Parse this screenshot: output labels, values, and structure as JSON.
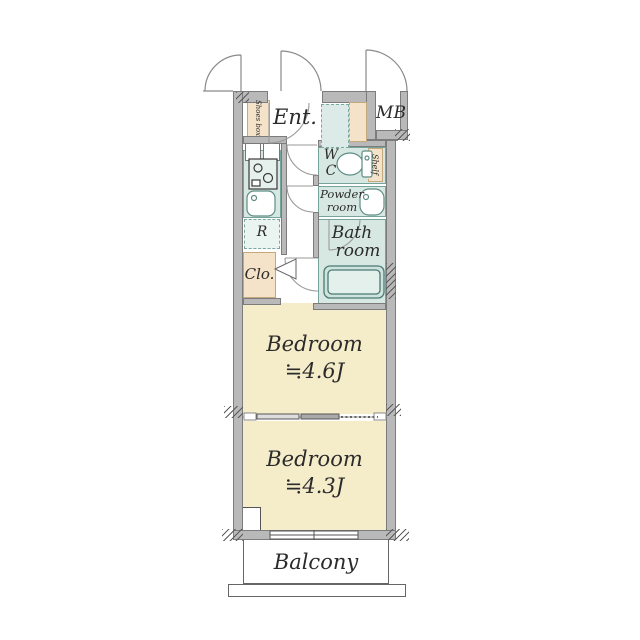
{
  "floor_plan": {
    "rooms": {
      "entrance": {
        "label": "Ent."
      },
      "meter_box": {
        "label": "MB"
      },
      "shoes_box": {
        "label": "Shoes box"
      },
      "washer_space": {
        "label": "W"
      },
      "entrance_shelf": {
        "label": "Shelf"
      },
      "wc": {
        "label_line1": "W",
        "label_line2": "C"
      },
      "wc_shelf": {
        "label": "Shelf"
      },
      "powder_room": {
        "label_line1": "Powder",
        "label_line2": "room"
      },
      "bath_room": {
        "label_line1": "Bath",
        "label_line2": "room"
      },
      "refrigerator_space": {
        "label": "R"
      },
      "closet": {
        "label": "Clo."
      },
      "bedroom_1": {
        "label": "Bedroom",
        "size": "≒4.6J"
      },
      "bedroom_2": {
        "label": "Bedroom",
        "size": "≒4.3J"
      },
      "balcony": {
        "label": "Balcony"
      }
    },
    "colors": {
      "wall": "#b9b9b9",
      "wet_area_fill": "#d7e8e3",
      "storage_fill": "#f4e3c8",
      "bedroom_fill": "#f5ecca",
      "outline": "#4d4d4d"
    }
  }
}
